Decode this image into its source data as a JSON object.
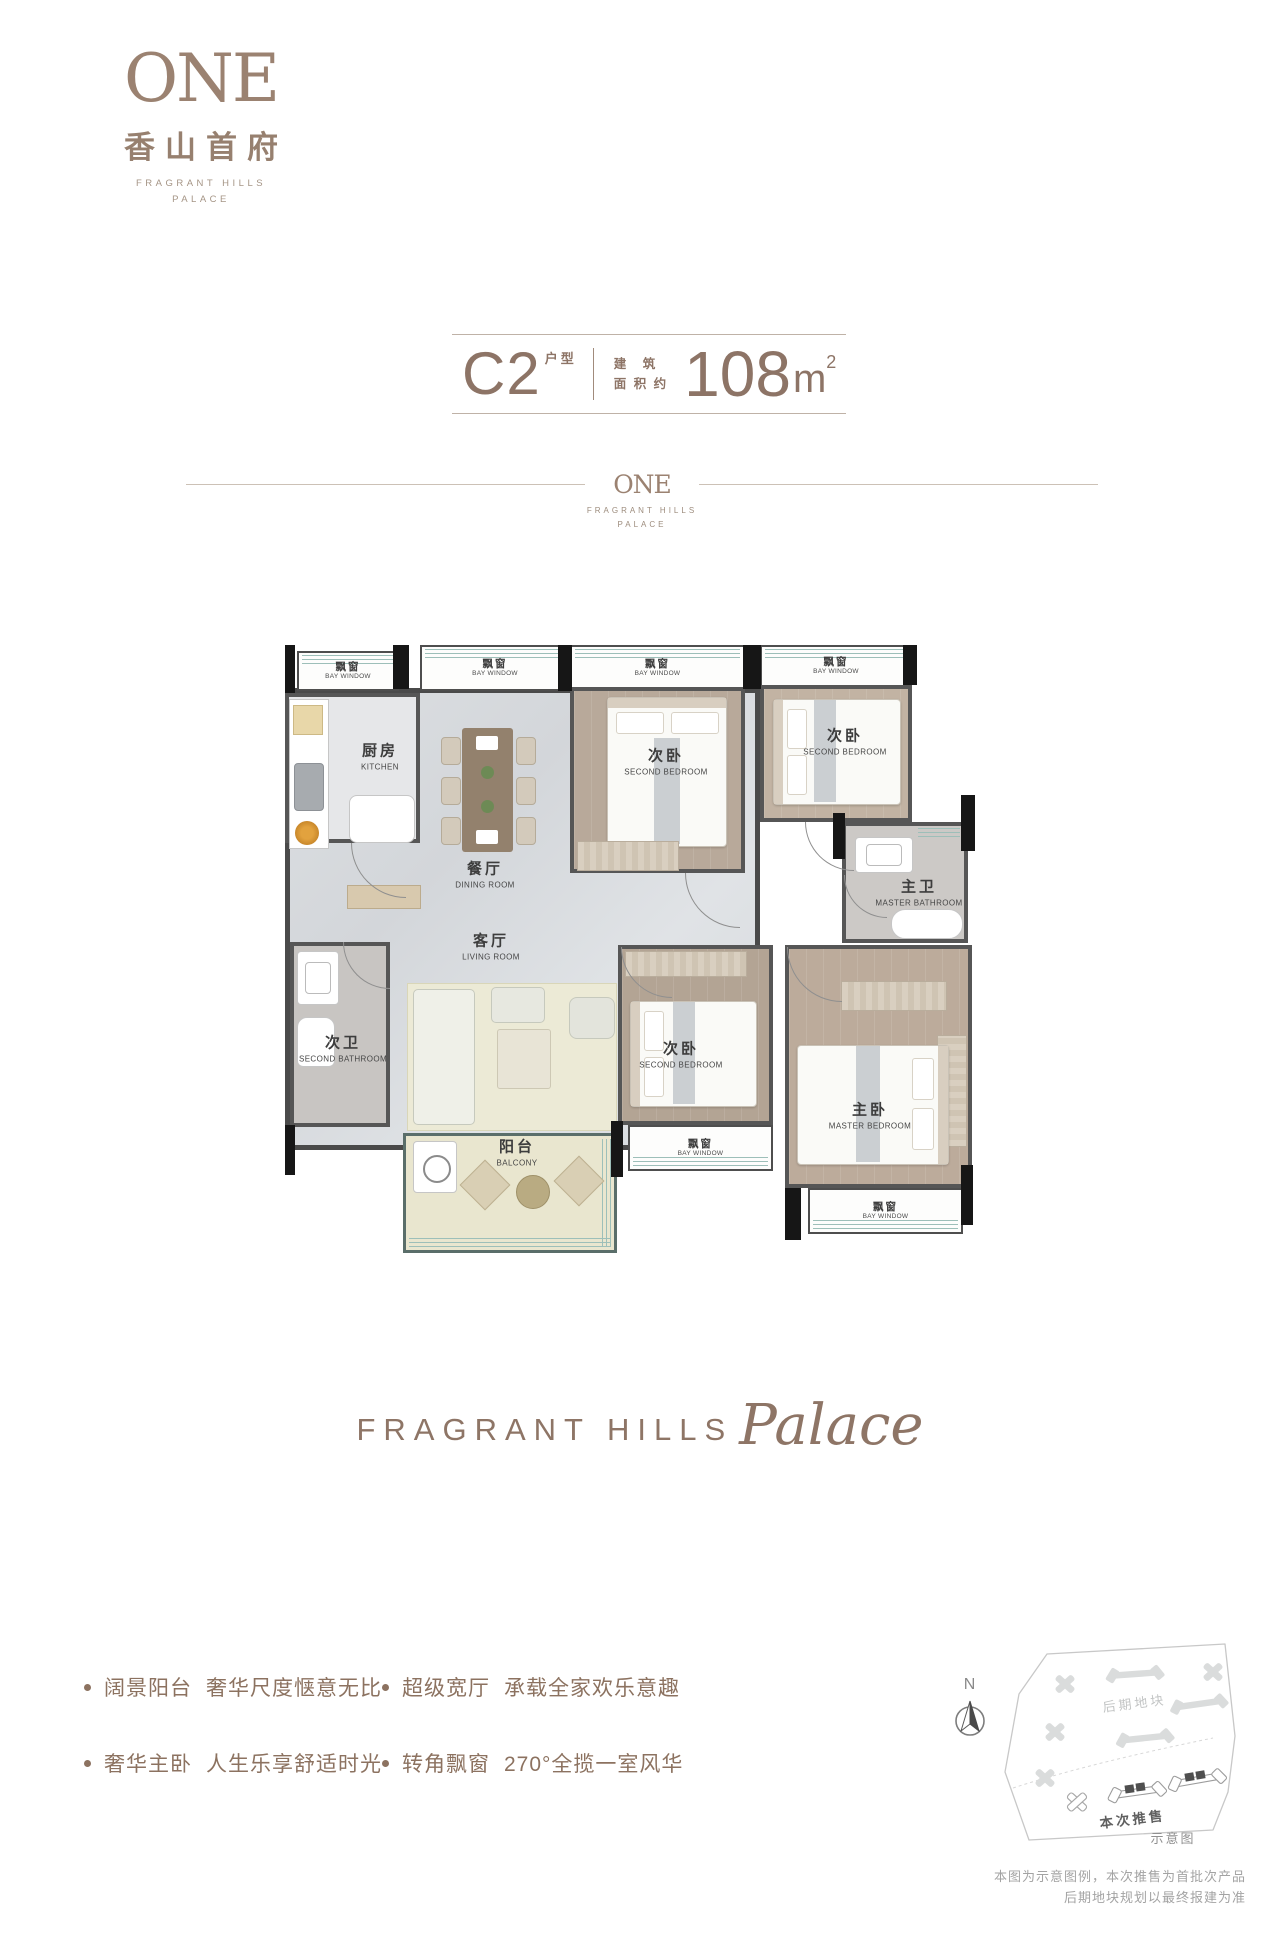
{
  "logo": {
    "mark": "ONE",
    "cn": "香山首府",
    "en1": "FRAGRANT HILLS",
    "en2": "PALACE"
  },
  "title": {
    "unit": "C2",
    "unit_tag": "户型",
    "area_tag1": "建　筑",
    "area_tag2": "面 积 约",
    "area_value": "108",
    "area_unit": "m",
    "area_exp": "2"
  },
  "divider": {
    "mark": "ONE",
    "en1": "FRAGRANT HILLS",
    "en2": "PALACE"
  },
  "floorplan": {
    "bay_window": {
      "cn": "飘窗",
      "en": "BAY WINDOW"
    },
    "rooms": {
      "kitchen": {
        "cn": "厨房",
        "en": "KITCHEN"
      },
      "dining": {
        "cn": "餐厅",
        "en": "DINING ROOM"
      },
      "living": {
        "cn": "客厅",
        "en": "LIVING ROOM"
      },
      "balcony": {
        "cn": "阳台",
        "en": "BALCONY"
      },
      "bedroom_a": {
        "cn": "次卧",
        "en": "SECOND BEDROOM"
      },
      "bedroom_b": {
        "cn": "次卧",
        "en": "SECOND BEDROOM"
      },
      "bedroom_c": {
        "cn": "次卧",
        "en": "SECOND BEDROOM"
      },
      "master_bedroom": {
        "cn": "主卧",
        "en": "MASTER BEDROOM"
      },
      "master_bath": {
        "cn": "主卫",
        "en": "MASTER BATHROOM"
      },
      "second_bath": {
        "cn": "次卫",
        "en": "SECOND BATHROOM"
      }
    }
  },
  "brand_script": {
    "caps": "FRAGRANT HILLS",
    "script": "Palace"
  },
  "features": [
    {
      "title": "阔景阳台",
      "desc": "奢华尺度惬意无比"
    },
    {
      "title": "超级宽厅",
      "desc": "承载全家欢乐意趣"
    },
    {
      "title": "奢华主卧",
      "desc": "人生乐享舒适时光"
    },
    {
      "title": "转角飘窗",
      "desc": "270°全揽一室风华"
    }
  ],
  "sitemap": {
    "north": "N",
    "phase_later": "后期地块",
    "phase_now": "本次推售",
    "caption": "示意图",
    "note1": "本图为示意图例，本次推售为首批次产品",
    "note2": "后期地块规划以最终报建为准"
  }
}
